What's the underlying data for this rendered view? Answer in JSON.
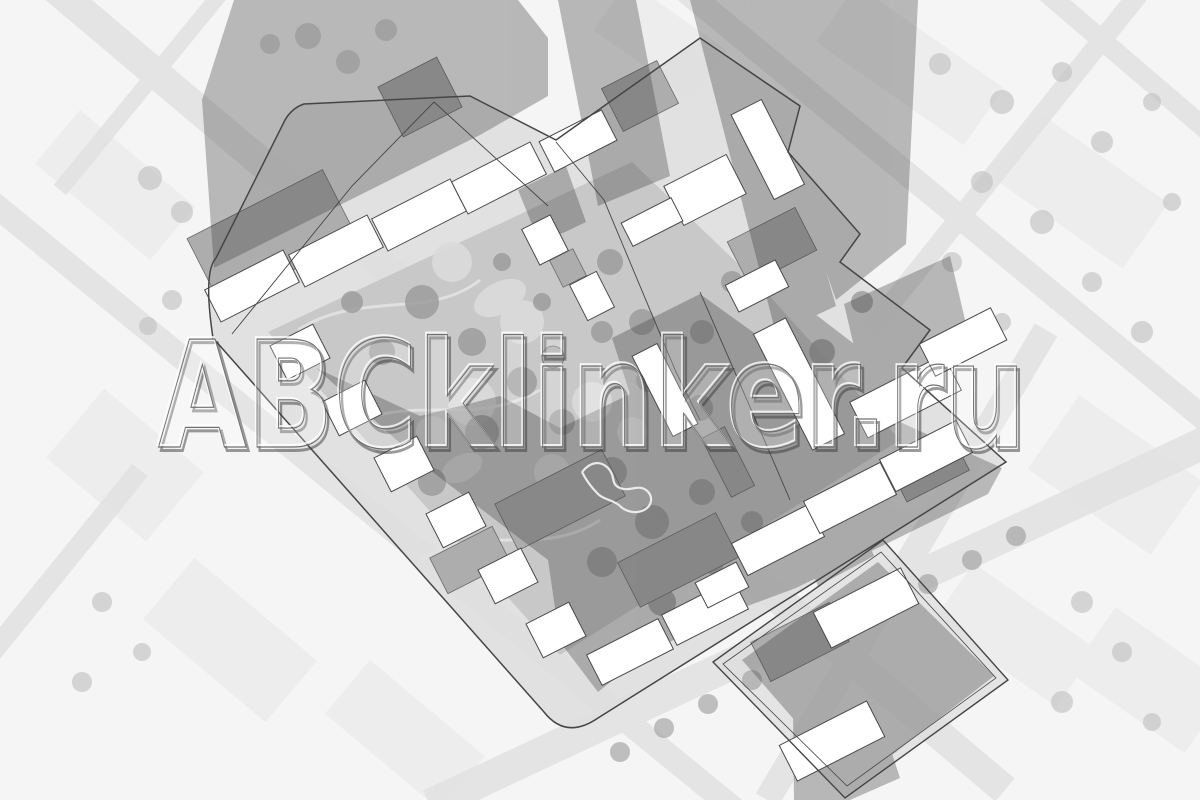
{
  "watermark": {
    "text": "ABCklinker.ru"
  },
  "plan": {
    "colors": {
      "background": "#f5f5f5",
      "block_faint": "#ececec",
      "street": "#e3e3e3",
      "site_ground": "#dedede",
      "courtyard": "#c6c6c6",
      "tree_light": "#c2c2c2",
      "tree_dark": "#9a9a9a",
      "roof_white": "#ffffff",
      "roof_gray": "#adadad",
      "shadow": "#3c3c3c",
      "outline": "#454545",
      "path_light": "#e2e2e2"
    }
  }
}
